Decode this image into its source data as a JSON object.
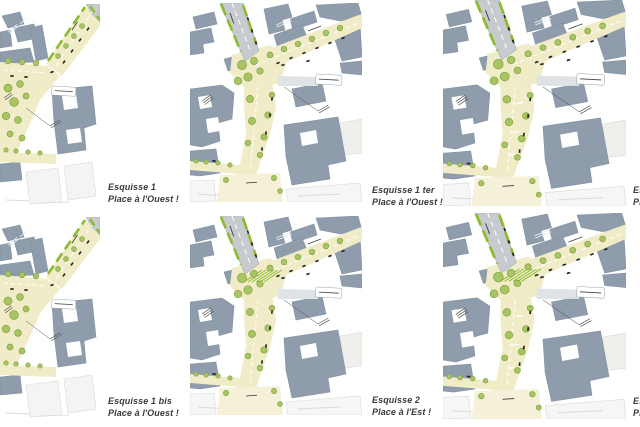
{
  "figure": {
    "background": "#ffffff",
    "grid": "2 rows x 3 columns of urban plan sketches"
  },
  "palette": {
    "building": "#8e9cab",
    "building_edge": "#8393a2",
    "faint_building": "#efefec",
    "faint_edge": "#d9dbd8",
    "road": "#f1ecc8",
    "road_light": "#f5f1d8",
    "gray_road": "#c7cbcf",
    "gray_stub": "#dfe3e6",
    "green_lane": "#8cbb2f",
    "tree_fill": "#a9c464",
    "tree_edge": "#84a43f",
    "mark_black": "#222222",
    "annotation_gray": "#555555",
    "caption_color": "#3a3a3a",
    "white_line": "#ffffff"
  },
  "maps": [
    {
      "id": "esquisse-1",
      "column": 1,
      "hatch": false,
      "bike": false,
      "caption": {
        "line1": "Esquisse 1",
        "line2": "Place à l'Ouest !",
        "clipped": false
      }
    },
    {
      "id": "esquisse-1-ter",
      "column": 2,
      "hatch": false,
      "bike": false,
      "caption": {
        "line1": "Esquisse 1 ter",
        "line2": "Place à l'Ouest !",
        "clipped": false
      }
    },
    {
      "id": "esquisse-top-right",
      "column": 3,
      "hatch": false,
      "bike": true,
      "caption": {
        "line1": "Esquisse",
        "line2": "Place",
        "clipped": true
      }
    },
    {
      "id": "esquisse-1-bis",
      "column": 1,
      "hatch": false,
      "bike": false,
      "caption": {
        "line1": "Esquisse 1 bis",
        "line2": "Place à l'Ouest !",
        "clipped": false
      }
    },
    {
      "id": "esquisse-2",
      "column": 2,
      "hatch": true,
      "bike": false,
      "caption": {
        "line1": "Esquisse 2",
        "line2": "Place à l'Est !",
        "clipped": false
      }
    },
    {
      "id": "esquisse-bottom-right",
      "column": 3,
      "hatch": true,
      "bike": true,
      "caption": {
        "line1": "Esquisse",
        "line2": "Place",
        "clipped": true
      }
    }
  ]
}
